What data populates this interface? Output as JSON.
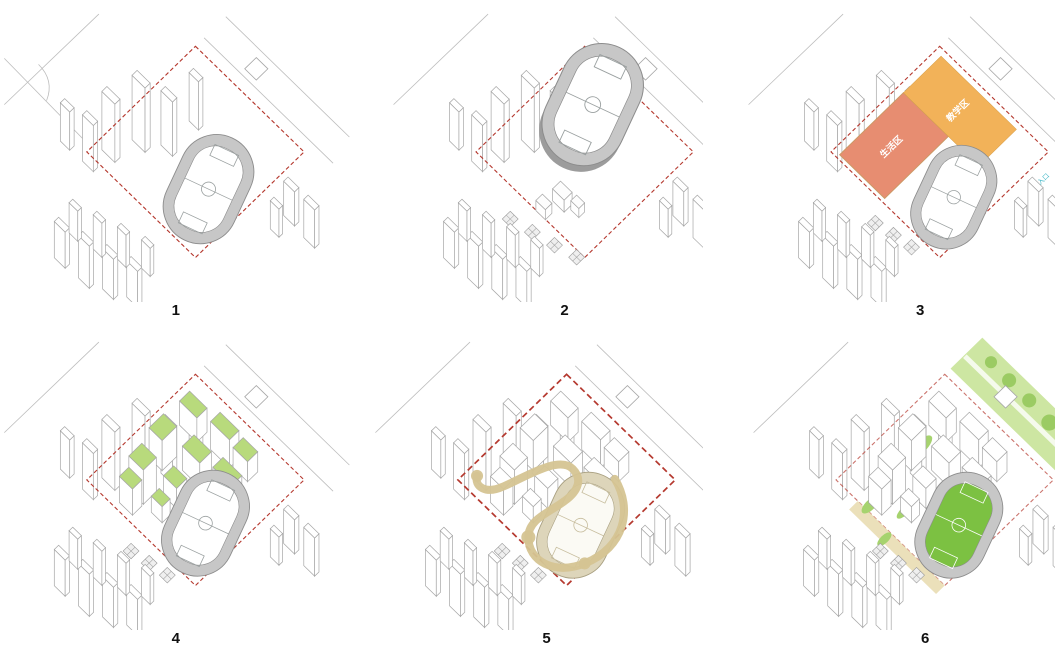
{
  "palette": {
    "boundary_red": "#b5392f",
    "context_line": "#a7a7a7",
    "road_line": "#bdbdbd",
    "track_ring": "#c7c7c7",
    "track_edge": "#8c8c8c",
    "field_marking": "#9aa0a0",
    "living_zone_salmon": "#e78d71",
    "teaching_zone_orange": "#f2b259",
    "zone_label_white": "#ffffff",
    "entrance_cyan": "#3cb6c6",
    "roof_green": "#b8da7c",
    "landscape_green": "#cde6a2",
    "tree_green": "#9bcb63",
    "patch_green": "#a6d36e",
    "field_green": "#7cc142",
    "ribbon_tan": "#d5c492",
    "ribbon_pale": "#ddd5ba",
    "ground_tan": "#e9ddb2"
  },
  "panels": [
    {
      "number": "1"
    },
    {
      "number": "2"
    },
    {
      "number": "3",
      "labels": {
        "living_zone": "生活区",
        "teaching_zone": "教学区",
        "campus_entrance": "校园入口"
      }
    },
    {
      "number": "4"
    },
    {
      "number": "5"
    },
    {
      "number": "6"
    }
  ]
}
